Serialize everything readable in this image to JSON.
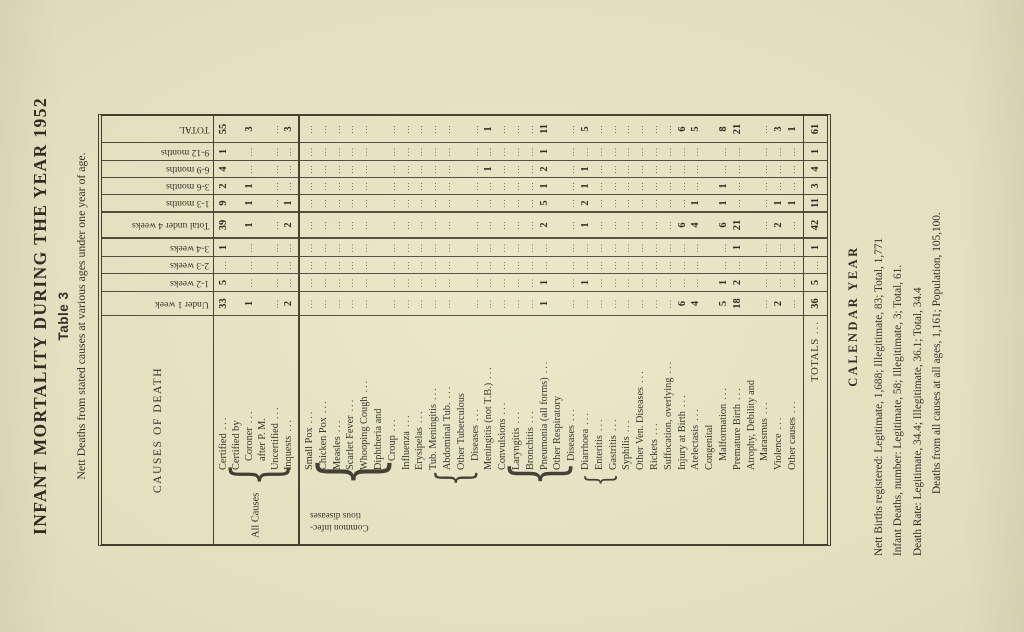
{
  "colors": {
    "paper": "#e9e6c6",
    "ink": "#2b2820"
  },
  "page": {
    "title": "INFANT MORTALITY DURING THE YEAR 1952",
    "table_label": "Table 3",
    "subtitle": "Nett Deaths from stated causes at various ages under one year of age."
  },
  "table": {
    "causes_header": "CAUSES OF DEATH",
    "dots": "...",
    "col_headers": [
      "Under 1 week",
      "1-2 weeks",
      "2-3 weeks",
      "3-4 weeks",
      "Total under 4 weeks",
      "1-3 months",
      "3-6 months",
      "6-9 months",
      "9-12 months",
      "TOTAL"
    ],
    "all_causes": {
      "side_label": "All Causes",
      "rows": [
        {
          "lines": [
            "Certified"
          ],
          "value_line": 0,
          "cells": [
            33,
            5,
            "...",
            1,
            39,
            9,
            2,
            4,
            1,
            55
          ]
        },
        {
          "lines": [
            "Certified by",
            "Coroner",
            "after P. M."
          ],
          "value_line": 1,
          "cells": [
            1,
            "...",
            "...",
            "...",
            1,
            1,
            1,
            "...",
            "...",
            3
          ]
        },
        {
          "lines": [
            "Uncertified"
          ],
          "value_line": 0,
          "cells": [
            "...",
            "...",
            "...",
            "...",
            "...",
            "...",
            "...",
            "...",
            "...",
            "..."
          ]
        },
        {
          "lines": [
            "Inquests"
          ],
          "value_line": 0,
          "cells": [
            2,
            "...",
            "...",
            "...",
            2,
            1,
            "...",
            "...",
            "...",
            3
          ]
        }
      ]
    },
    "group_label_lines": [
      "Common infec-",
      "tious diseases"
    ],
    "braces": [
      {
        "from_line": 0,
        "to_line": 7
      },
      {
        "from_line": 9,
        "to_line": 13
      },
      {
        "from_line": 14,
        "to_line": 20
      },
      {
        "from_line": 20,
        "to_line": 23
      }
    ],
    "causes": [
      {
        "lines": [
          "Small Pox"
        ],
        "cells": [
          "...",
          "...",
          "...",
          "...",
          "...",
          "...",
          "...",
          "...",
          "...",
          "..."
        ]
      },
      {
        "lines": [
          "Chicken Pox"
        ],
        "cells": [
          "...",
          "...",
          "...",
          "...",
          "...",
          "...",
          "...",
          "...",
          "...",
          "..."
        ]
      },
      {
        "lines": [
          "Measles"
        ],
        "cells": [
          "...",
          "...",
          "...",
          "...",
          "...",
          "...",
          "...",
          "...",
          "...",
          "..."
        ]
      },
      {
        "lines": [
          "Scarlet Fever"
        ],
        "cells": [
          "...",
          "...",
          "...",
          "...",
          "...",
          "...",
          "...",
          "...",
          "...",
          "..."
        ]
      },
      {
        "lines": [
          "Whooping Cough"
        ],
        "cells": [
          "...",
          "...",
          "...",
          "...",
          "...",
          "...",
          "...",
          "...",
          "...",
          "..."
        ]
      },
      {
        "lines": [
          "Diphtheria and",
          "Croup"
        ],
        "cells": [
          "...",
          "...",
          "...",
          "...",
          "...",
          "...",
          "...",
          "...",
          "...",
          "..."
        ]
      },
      {
        "lines": [
          "Influenza"
        ],
        "cells": [
          "...",
          "...",
          "...",
          "...",
          "...",
          "...",
          "...",
          "...",
          "...",
          "..."
        ]
      },
      {
        "lines": [
          "Erysipelas"
        ],
        "cells": [
          "...",
          "...",
          "...",
          "...",
          "...",
          "...",
          "...",
          "...",
          "...",
          "..."
        ]
      },
      {
        "lines": [
          "Tub. Meningitis"
        ],
        "cells": [
          "...",
          "...",
          "...",
          "...",
          "...",
          "...",
          "...",
          "...",
          "...",
          "..."
        ]
      },
      {
        "lines": [
          "Abdominal Tub."
        ],
        "cells": [
          "...",
          "...",
          "...",
          "...",
          "...",
          "...",
          "...",
          "...",
          "...",
          "..."
        ]
      },
      {
        "lines": [
          "Other Tuberculous",
          "Diseases"
        ],
        "cells": [
          "...",
          "...",
          "...",
          "...",
          "...",
          "...",
          "...",
          "...",
          "...",
          "..."
        ]
      },
      {
        "lines": [
          "Meningitis (not T.B.)"
        ],
        "cells": [
          "...",
          "...",
          "...",
          "...",
          "...",
          "...",
          "...",
          1,
          "...",
          1
        ]
      },
      {
        "lines": [
          "Convulsions"
        ],
        "cells": [
          "...",
          "...",
          "...",
          "...",
          "...",
          "...",
          "...",
          "...",
          "...",
          "..."
        ]
      },
      {
        "lines": [
          "Laryngitis"
        ],
        "cells": [
          "...",
          "...",
          "...",
          "...",
          "...",
          "...",
          "...",
          "...",
          "...",
          "..."
        ]
      },
      {
        "lines": [
          "Bronchitis"
        ],
        "cells": [
          "...",
          "...",
          "...",
          "...",
          "...",
          "...",
          "...",
          "...",
          "...",
          "..."
        ]
      },
      {
        "lines": [
          "Pneumonia (all forms)"
        ],
        "cells": [
          1,
          1,
          "...",
          "...",
          2,
          5,
          1,
          2,
          1,
          11
        ]
      },
      {
        "lines": [
          "Other Respiratory",
          "Diseases"
        ],
        "cells": [
          "...",
          "...",
          "...",
          "...",
          "...",
          "...",
          "...",
          "...",
          "...",
          "..."
        ]
      },
      {
        "lines": [
          "Diarrhoea"
        ],
        "cells": [
          "...",
          1,
          "...",
          "...",
          1,
          2,
          1,
          1,
          "...",
          5
        ]
      },
      {
        "lines": [
          "Enteritis"
        ],
        "cells": [
          "...",
          "...",
          "...",
          "...",
          "...",
          "...",
          "...",
          "...",
          "...",
          "..."
        ]
      },
      {
        "lines": [
          "Gastritis"
        ],
        "cells": [
          "...",
          "...",
          "...",
          "...",
          "...",
          "...",
          "...",
          "...",
          "...",
          "..."
        ]
      },
      {
        "lines": [
          "Syphilis"
        ],
        "cells": [
          "...",
          "...",
          "...",
          "...",
          "...",
          "...",
          "...",
          "...",
          "...",
          "..."
        ]
      },
      {
        "lines": [
          "Other Ven. Diseases"
        ],
        "cells": [
          "...",
          "...",
          "...",
          "...",
          "...",
          "...",
          "...",
          "...",
          "...",
          "..."
        ]
      },
      {
        "lines": [
          "Rickets"
        ],
        "cells": [
          "...",
          "...",
          "...",
          "...",
          "...",
          "...",
          "...",
          "...",
          "...",
          "..."
        ]
      },
      {
        "lines": [
          "Suffocation, overlying"
        ],
        "cells": [
          "...",
          "...",
          "...",
          "...",
          "...",
          "...",
          "...",
          "...",
          "...",
          "..."
        ]
      },
      {
        "lines": [
          "Injury at Birth"
        ],
        "cells": [
          6,
          "...",
          "...",
          "...",
          6,
          "...",
          "...",
          "...",
          "...",
          6
        ]
      },
      {
        "lines": [
          "Atelectasis"
        ],
        "cells": [
          4,
          "...",
          "...",
          "...",
          4,
          1,
          "...",
          "...",
          "...",
          5
        ]
      },
      {
        "lines": [
          "Congenital",
          "Malformation"
        ],
        "cells": [
          5,
          1,
          "...",
          "...",
          6,
          1,
          1,
          "...",
          "...",
          8
        ]
      },
      {
        "lines": [
          "Premature Birth"
        ],
        "cells": [
          18,
          2,
          "...",
          1,
          21,
          "...",
          "...",
          "...",
          "...",
          21
        ]
      },
      {
        "lines": [
          "Atrophy, Debility and",
          "Marasmus"
        ],
        "cells": [
          "...",
          "...",
          "...",
          "...",
          "...",
          "...",
          "...",
          "...",
          "...",
          "..."
        ]
      },
      {
        "lines": [
          "Violence"
        ],
        "cells": [
          2,
          "...",
          "...",
          "...",
          2,
          1,
          "...",
          "...",
          "...",
          3
        ]
      },
      {
        "lines": [
          "Other causes"
        ],
        "cells": [
          "...",
          "...",
          "...",
          "...",
          "...",
          1,
          "...",
          "...",
          "...",
          1
        ]
      }
    ],
    "totals_row": {
      "label": "TOTALS",
      "cells": [
        36,
        5,
        "...",
        1,
        42,
        11,
        3,
        4,
        1,
        61
      ]
    }
  },
  "footer": {
    "heading": "CALENDAR YEAR",
    "lines": [
      "Nett Births registered: Legitimate, 1,688; Illegitimate, 83; Total, 1,771",
      "Infant Deaths, number: Legitimate, 58; Illegitimate, 3; Total, 61.",
      "Death Rate: Legitimate, 34.4; Illegitimate, 36.1; Total, 34.4",
      "Deaths from all causes at all ages, 1,161; Population, 105,100."
    ]
  }
}
